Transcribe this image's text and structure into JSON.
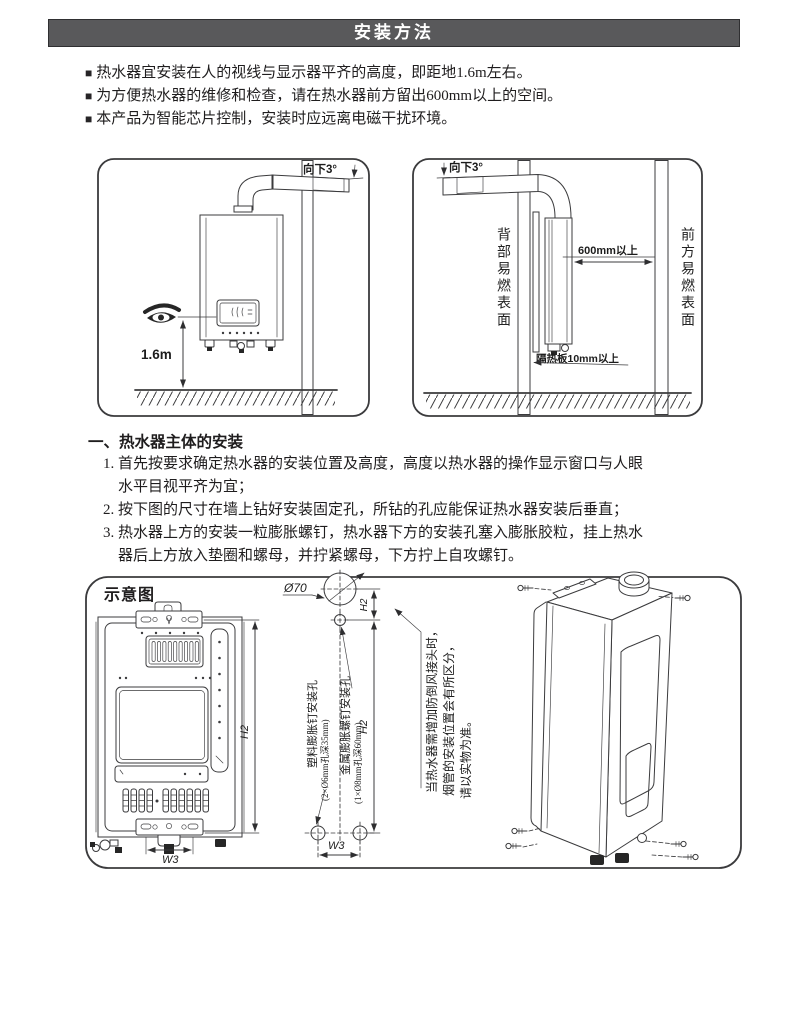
{
  "header": {
    "title": "安装方法"
  },
  "bullet_marker": "■",
  "bullets": [
    "热水器宜安装在人的视线与显示器平齐的高度，即距地1.6m左右。",
    "为方便热水器的维修和检查，请在热水器前方留出600mm以上的空间。",
    "本产品为智能芯片控制，安装时应远离电磁干扰环境。"
  ],
  "fig_install": {
    "angle": "向下3°",
    "height": "1.6m"
  },
  "fig_clearance": {
    "angle": "向下3°",
    "rear": "背部易燃表面",
    "front": "前方易燃表面",
    "gap": "600mm以上",
    "board": "隔热板10mm以上"
  },
  "section": {
    "heading": "一、热水器主体的安装",
    "items": [
      {
        "num": "1.",
        "text": "首先按要求确定热水器的安装位置及高度，高度以热水器的操作显示窗口与人眼\n水平目视平齐为宜；"
      },
      {
        "num": "2.",
        "text": "按下图的尺寸在墙上钻好安装固定孔，所钻的孔应能保证热水器安装后垂直；"
      },
      {
        "num": "3.",
        "text": "热水器上方的安装一粒膨胀螺钉，热水器下方的安装孔塞入膨胀胶粒，挂上热水\n器后上方放入垫圈和螺母，并拧紧螺母，下方拧上自攻螺钉。"
      }
    ]
  },
  "schematic": {
    "title": "示意图",
    "flue": "Ø70",
    "h_top": "H2",
    "h_main": "H2",
    "h_front": "H2",
    "w_front": "W3",
    "w_holes": "W3",
    "hole_plastic": "塑料膨胀钉安装孔",
    "hole_plastic_spec": "(2×Ø6mm孔深35mm)",
    "hole_metal": "金属膨胀螺钉安装孔",
    "hole_metal_spec": "(1×Ø8mm孔深60mm)",
    "note1": "当热水器需增加防倒风接头时，",
    "note2": "烟管的安装位置会有所区分，",
    "note3": "请以实物为准。"
  },
  "colors": {
    "header_bg": "#59595b",
    "ink": "#1f1d1e",
    "line": "#3b3b3d"
  }
}
